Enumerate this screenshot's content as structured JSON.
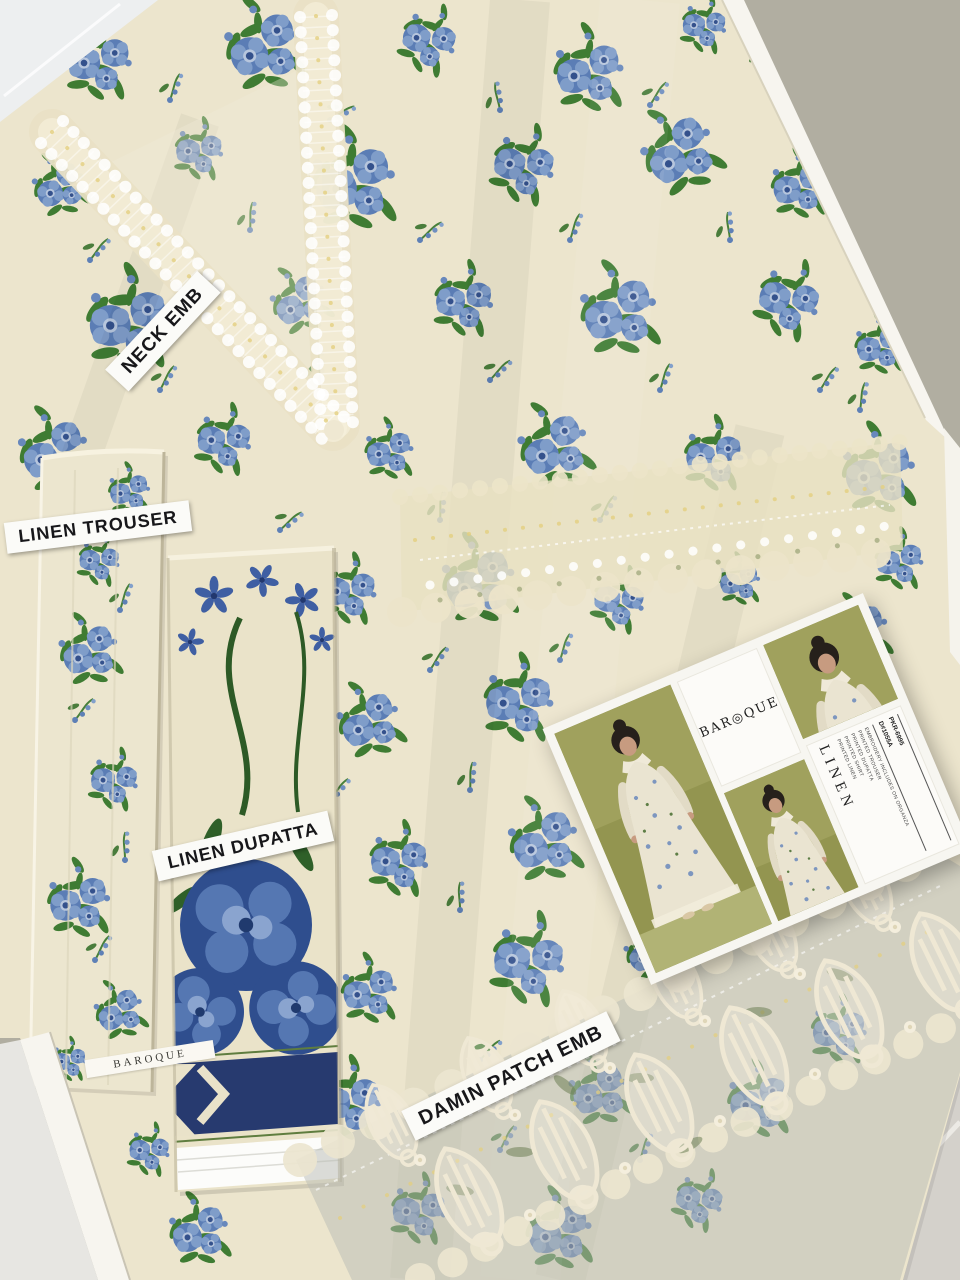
{
  "labels": {
    "neck_emb": "NECK EMB",
    "linen_trouser": "LINEN TROUSER",
    "linen_dupatta": "LINEN DUPATTA",
    "damin_patch_emb": "DAMIN PATCH EMB"
  },
  "selvage": {
    "brand": "BAROQUE"
  },
  "card": {
    "brand_display": "BAR◎QUE",
    "collection": "LINEN",
    "details": [
      "PRINTED LINEN",
      "PRINTED SHIRT",
      "PRINTED DUPATTA",
      "PRINTED TROUSER",
      "EMBROIDERY INCLUDES ON ORGANZA"
    ],
    "design_code": "D#1055A",
    "price": "PKR-6995"
  },
  "colors": {
    "fabric_cream": "#ece5cd",
    "floral_blue": "#5b7db5",
    "floral_navy": "#2f4e8e",
    "leaf_green": "#3f7c33",
    "lace_cream": "#e9e1c5",
    "dupatta_navy_band": "#273a6f",
    "card_photo_olive": "#8f9252",
    "floor_gray": "#b1aea1",
    "tile_gray": "#d4d1cb",
    "label_bg": "#fbfbf8",
    "label_text": "#17171a"
  }
}
